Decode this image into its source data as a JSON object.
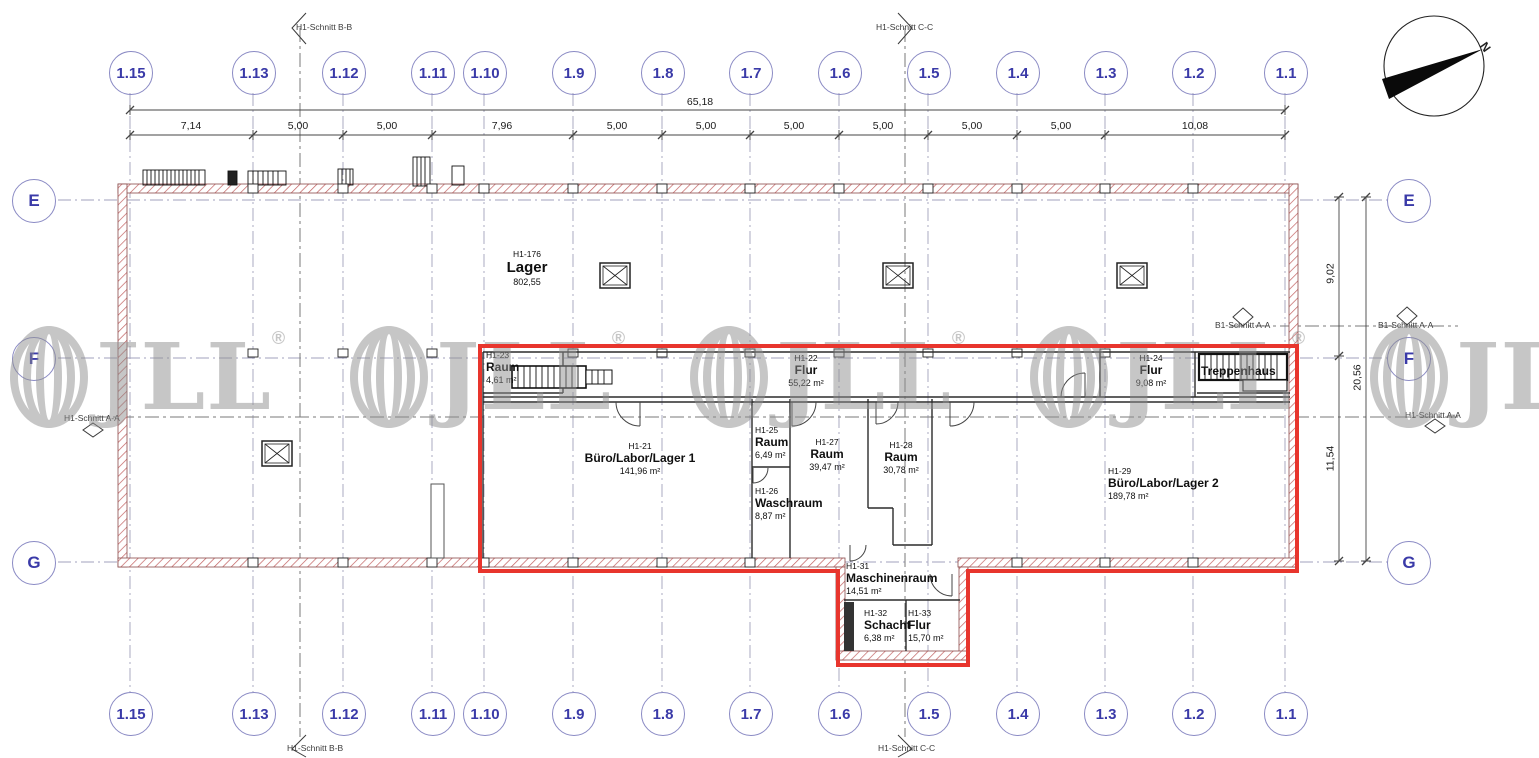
{
  "watermark": {
    "text": "JLL",
    "reg": "®"
  },
  "compass": {
    "label": "N"
  },
  "grid_columns": [
    {
      "label": "1.15"
    },
    {
      "label": "1.13"
    },
    {
      "label": "1.12"
    },
    {
      "label": "1.11"
    },
    {
      "label": "1.10"
    },
    {
      "label": "1.9"
    },
    {
      "label": "1.8"
    },
    {
      "label": "1.7"
    },
    {
      "label": "1.6"
    },
    {
      "label": "1.5"
    },
    {
      "label": "1.4"
    },
    {
      "label": "1.3"
    },
    {
      "label": "1.2"
    },
    {
      "label": "1.1"
    }
  ],
  "grid_rows": [
    {
      "label": "E"
    },
    {
      "label": "F"
    },
    {
      "label": "G"
    }
  ],
  "dimensions": {
    "total_top": "65,18",
    "top_segments": [
      "7,14",
      "5,00",
      "5,00",
      "7,96",
      "5,00",
      "5,00",
      "5,00",
      "5,00",
      "5,00",
      "5,00",
      "10,08"
    ],
    "right_e_f": "9,02",
    "right_total": "20,56",
    "right_f_g": "11,54"
  },
  "sections": {
    "schnitt_bb": "H1-Schnitt B-B",
    "schnitt_cc": "H1-Schnitt C-C",
    "schnitt_aa": "H1-Schnitt A-A",
    "schnitt_b1aa": "B1-Schnitt A-A"
  },
  "rooms": {
    "lager": {
      "id": "H1-176",
      "name": "Lager",
      "area": "802,55"
    },
    "raum23": {
      "id": "H1-23",
      "name": "Raum",
      "area": "4,61 m²"
    },
    "flur22": {
      "id": "H1-22",
      "name": "Flur",
      "area": "55,22 m²"
    },
    "flur24": {
      "id": "H1-24",
      "name": "Flur",
      "area": "9,08 m²"
    },
    "treppenhaus": {
      "name": "Treppenhaus"
    },
    "buero1": {
      "id": "H1-21",
      "name": "Büro/Labor/Lager 1",
      "area": "141,96 m²"
    },
    "raum25": {
      "id": "H1-25",
      "name": "Raum",
      "area": "6,49 m²"
    },
    "waschraum": {
      "id": "H1-26",
      "name": "Waschraum",
      "area": "8,87 m²"
    },
    "raum27": {
      "id": "H1-27",
      "name": "Raum",
      "area": "39,47 m²"
    },
    "raum28": {
      "id": "H1-28",
      "name": "Raum",
      "area": "30,78 m²"
    },
    "buero2": {
      "id": "H1-29",
      "name": "Büro/Labor/Lager 2",
      "area": "189,78 m²"
    },
    "maschinenraum": {
      "id": "H1-31",
      "name": "Maschinenraum",
      "area": "14,51 m²"
    },
    "schacht": {
      "id": "H1-32",
      "name": "Schacht",
      "area": "6,38 m²"
    },
    "flur33": {
      "id": "H1-33",
      "name": "Flur",
      "area": "15,70 m²"
    }
  },
  "colors": {
    "highlight_red": "#e8352d",
    "grid_blue": "#3a3aa8",
    "wall_hatch": "#c26060"
  }
}
